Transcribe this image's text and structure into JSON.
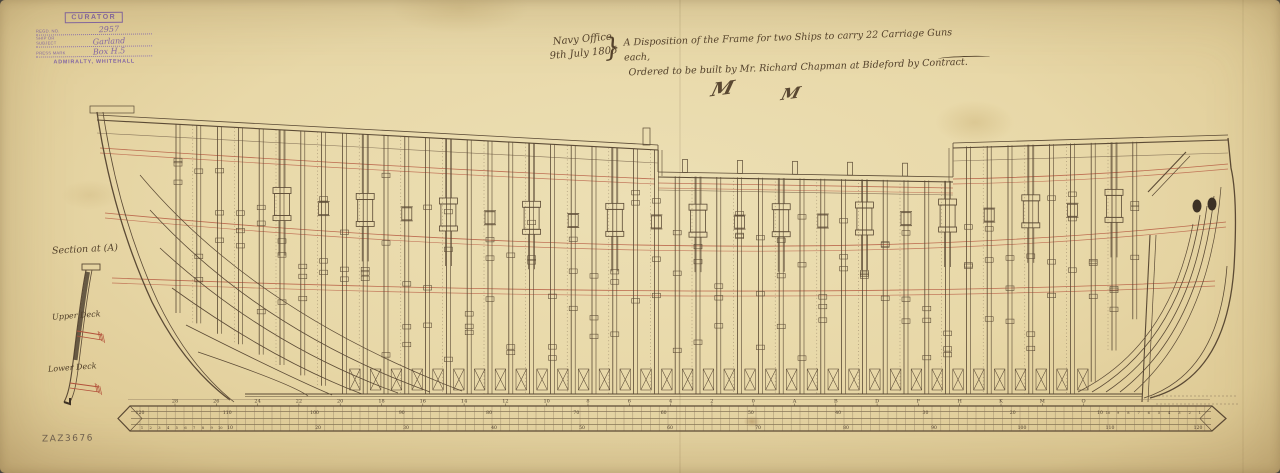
{
  "document_kind": "ship-frame-disposition-plan",
  "stamp": {
    "title": "CURATOR",
    "fields": [
      {
        "label": "Regd. No.",
        "value": "2957"
      },
      {
        "label": "Ship or Subject",
        "value": "Garland"
      },
      {
        "label": "Press Mark",
        "value": "Box H.5"
      }
    ],
    "footer": "ADMIRALTY, WHITEHALL"
  },
  "inscription": {
    "office": "Navy Office",
    "date": "9th July 1805",
    "brace": "}",
    "title_line1": "A Disposition of the Frame for two Ships to carry 22 Carriage Guns each,",
    "title_line2": "Ordered to be built by Mr. Richard Chapman at Bideford by Contract.",
    "monograms": [
      "M",
      "M"
    ]
  },
  "section_view": {
    "label": "Section at (A)",
    "upper_deck_label": "Upper Deck",
    "lower_deck_label": "Lower Deck"
  },
  "stations": [
    "28",
    "26",
    "24",
    "22",
    "20",
    "18",
    "16",
    "14",
    "12",
    "10",
    "8",
    "6",
    "4",
    "2",
    "0",
    "A",
    "B",
    "D",
    "F",
    "H",
    "K",
    "M",
    "O"
  ],
  "keel_scale_top": [
    "120",
    "110",
    "100",
    "90",
    "80",
    "70",
    "60",
    "50",
    "40",
    "30",
    "20",
    "10"
  ],
  "keel_fine_top": [
    "10",
    "9",
    "8",
    "7",
    "6",
    "5",
    "4",
    "3",
    "2",
    "1"
  ],
  "keel_scale_bottom": [
    "10",
    "20",
    "30",
    "40",
    "50",
    "60",
    "70",
    "80",
    "90",
    "100",
    "110",
    "120"
  ],
  "keel_fine_bottom": [
    "1",
    "2",
    "3",
    "4",
    "5",
    "6",
    "7",
    "8",
    "9",
    "10"
  ],
  "archive_ref": "ZAZ3676",
  "colors": {
    "ink": "#5b4a35",
    "ink_faint": "#8a775c",
    "red": "#b2503a",
    "dark_fill": "#3d3226",
    "stamp_purple": "#7c5fa8",
    "paper": "#e8d8a8"
  }
}
